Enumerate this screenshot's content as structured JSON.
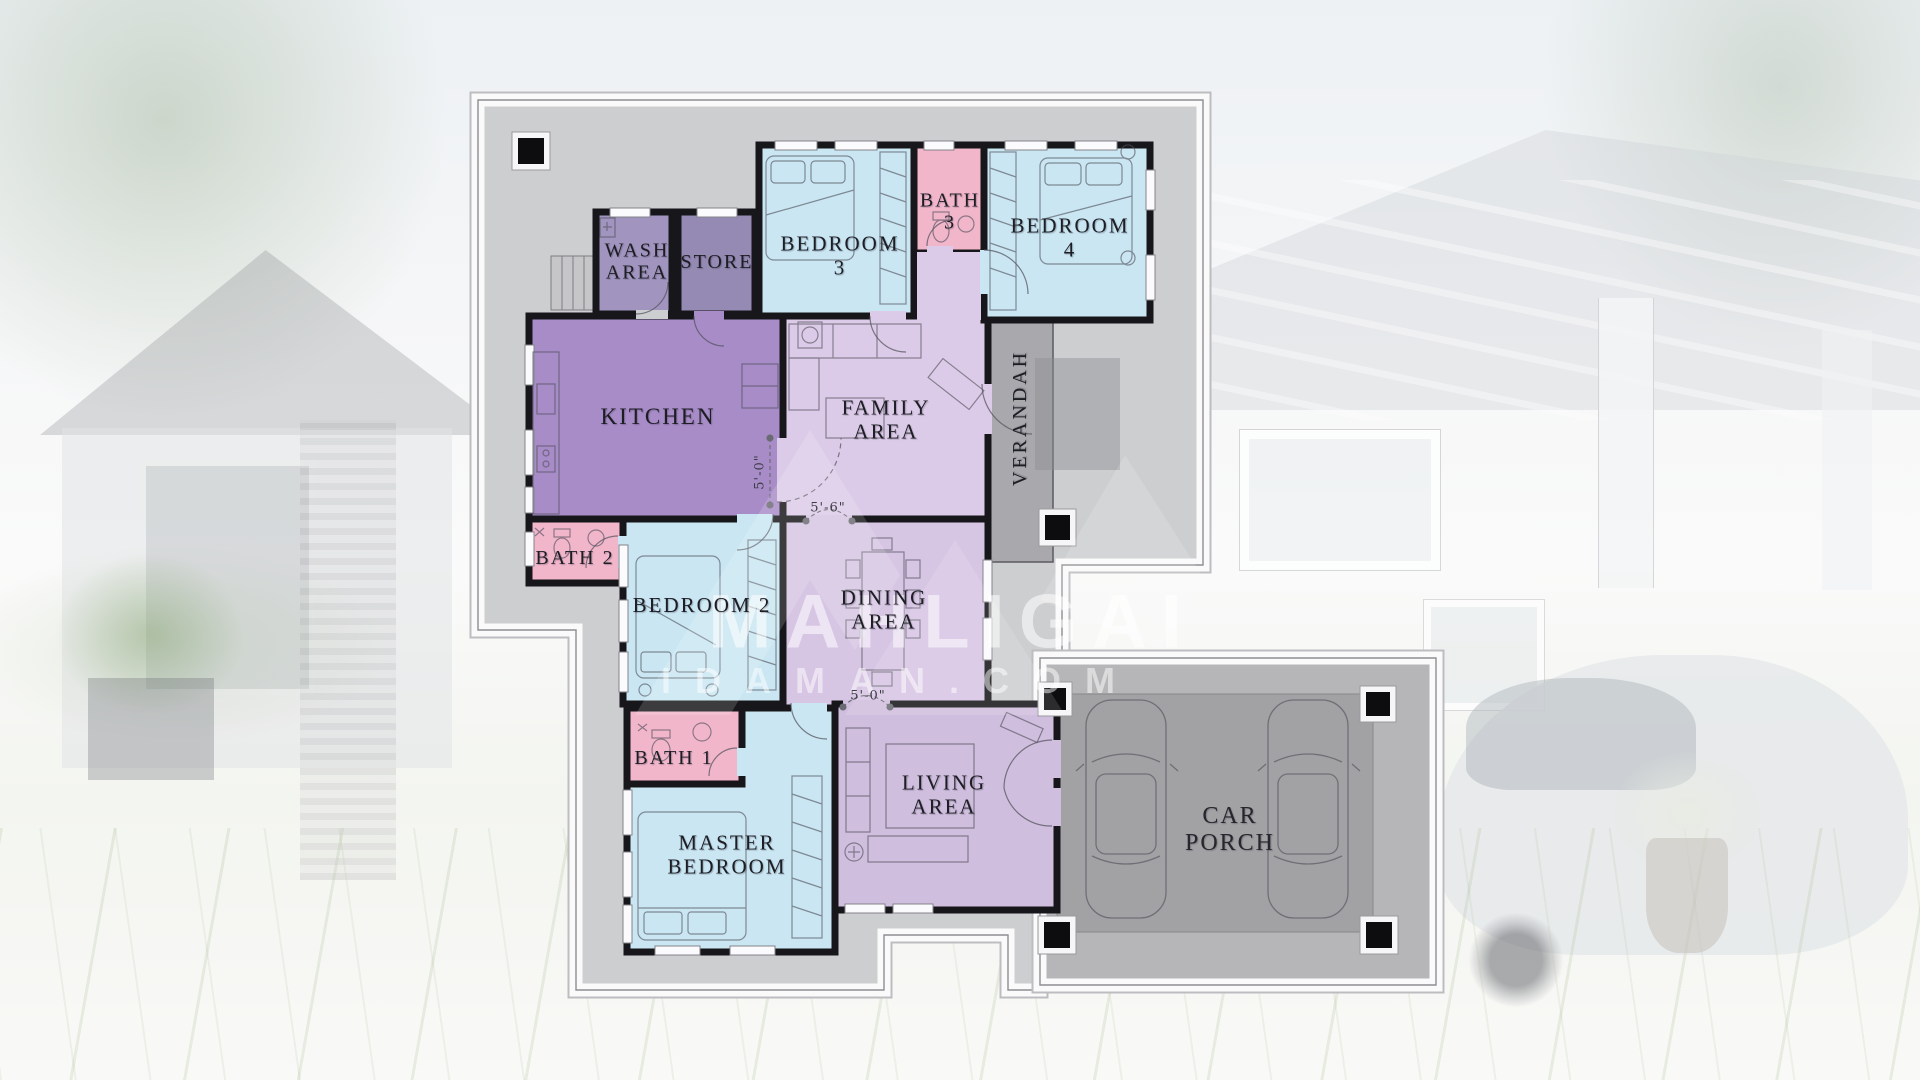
{
  "watermark": {
    "line1": "MAHLIGAI",
    "line2": "IDAMAN.COM"
  },
  "colors": {
    "plan_bg": "#cdced0",
    "wall": "#17171b",
    "bedroom": "#c9e6f2",
    "bath": "#f2b6cb",
    "kitchen": "#a88cc8",
    "wash": "#a195bf",
    "store": "#958ab3",
    "family": "#dccbe8",
    "dining": "#d7c5e4",
    "living": "#d0bede",
    "verandah": "#a9a9ad",
    "carporch_outer": "#b6b6b9",
    "carporch_inner": "#a2a2a5"
  },
  "rooms": [
    {
      "id": "wash-area",
      "line1": "WASH",
      "line2": "AREA"
    },
    {
      "id": "store",
      "line1": "STORE",
      "line2": ""
    },
    {
      "id": "bedroom-3",
      "line1": "BEDROOM",
      "line2": "3"
    },
    {
      "id": "bath-3",
      "line1": "BATH",
      "line2": "3"
    },
    {
      "id": "bedroom-4",
      "line1": "BEDROOM",
      "line2": "4"
    },
    {
      "id": "kitchen",
      "line1": "KITCHEN",
      "line2": ""
    },
    {
      "id": "family-area",
      "line1": "FAMILY",
      "line2": "AREA"
    },
    {
      "id": "verandah",
      "line1": "VERANDAH",
      "line2": ""
    },
    {
      "id": "bath-2",
      "line1": "BATH 2",
      "line2": ""
    },
    {
      "id": "bedroom-2",
      "line1": "BEDROOM 2",
      "line2": ""
    },
    {
      "id": "dining-area",
      "line1": "DINING",
      "line2": "AREA"
    },
    {
      "id": "bath-1",
      "line1": "BATH 1",
      "line2": ""
    },
    {
      "id": "master-bedroom",
      "line1": "MASTER",
      "line2": "BEDROOM"
    },
    {
      "id": "living-area",
      "line1": "LIVING",
      "line2": "AREA"
    },
    {
      "id": "car-porch",
      "line1": "CAR",
      "line2": "PORCH"
    }
  ],
  "dimensions": {
    "kitchen_passage": "5'-0\"",
    "family_dining": "5'-6\"",
    "dining_living": "5'-0\""
  }
}
